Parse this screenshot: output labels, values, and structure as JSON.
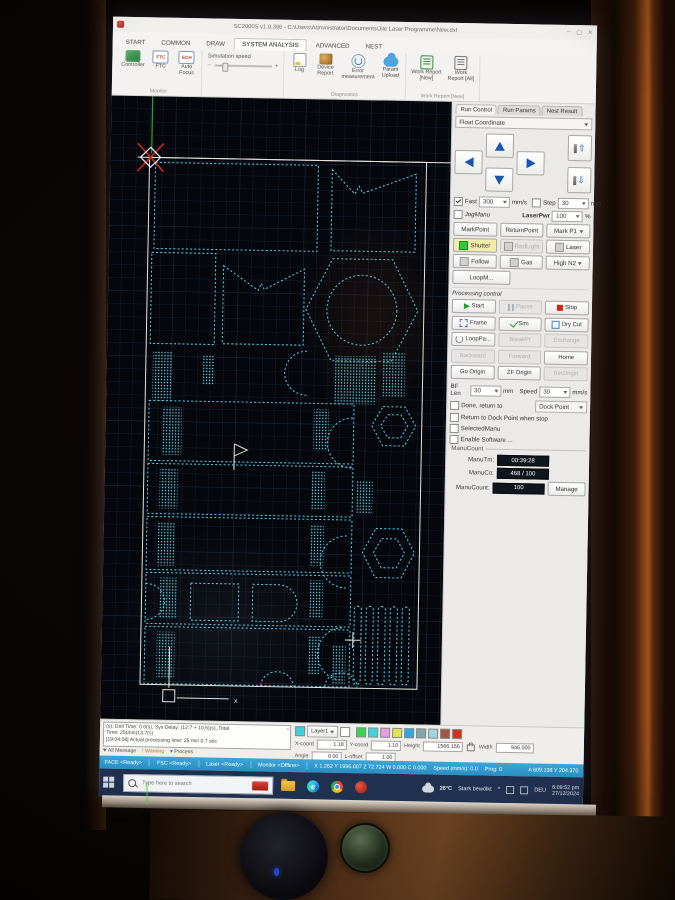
{
  "window": {
    "title": "SC2000S v1.0.396 - C:\\Users\\Administrator\\Documents\\Jile Laser Programme\\New.dxf",
    "min": "–",
    "max": "▢",
    "close": "✕"
  },
  "ribbon": {
    "tabs": [
      {
        "label": "START"
      },
      {
        "label": "COMMON"
      },
      {
        "label": "DRAW"
      },
      {
        "label": "SYSTEM ANALYSIS"
      },
      {
        "label": "ADVANCED"
      },
      {
        "label": "NEST"
      }
    ],
    "monitor_group": {
      "label": "Monitor",
      "controller": "Controller",
      "ftc": "FTC",
      "ftc_icon": "FTC",
      "auto_focus": "Auto\nFocus",
      "auto_focus_icon": "ECH"
    },
    "simulation": {
      "label": "Simulation speed",
      "minus": "–",
      "plus": "+"
    },
    "diagnostics": {
      "label": "Diagnostics",
      "log": "Log",
      "device_report": "Device\nReport",
      "error_measure": "Error\nmeasurement",
      "param_upload": "Param\nUpload"
    },
    "work_report": {
      "label": "Work Report [New]",
      "new": "Work Report\n[New]",
      "all": "Work\nReport [All]"
    }
  },
  "panel": {
    "tabs": [
      "Run Control",
      "Run Params",
      "Nest Result"
    ],
    "coord_mode": "Float Coordinate",
    "jog": {
      "fast_label": "Fast",
      "fast_value": "300",
      "fast_unit": "mm/s",
      "step_label": "Step",
      "step_value": "30",
      "step_unit": "mm",
      "jogmanu": "JogManu",
      "laserpwr_label": "LaserPwr",
      "laserpwr_value": "100",
      "laserpwr_unit": "%",
      "z_up": "⇧",
      "z_down": "⇩"
    },
    "quick": {
      "markpoint": "MarkPoint",
      "returnpoint": "ReturnPoint",
      "markp1": "Mark P1",
      "shutter": "Shutter",
      "redlight": "RedLight",
      "laser": "Laser",
      "follow": "Follow",
      "gas": "Gas",
      "highn2": "High N2",
      "loopm": "LoopM..."
    },
    "processing": {
      "label": "Processing control",
      "buttons": [
        {
          "label": "Start",
          "icon": "play",
          "disabled": false
        },
        {
          "label": "Pause",
          "icon": "pause",
          "disabled": true
        },
        {
          "label": "Stop",
          "icon": "stop",
          "disabled": false
        },
        {
          "label": "Frame",
          "icon": "frame",
          "disabled": false
        },
        {
          "label": "Sim",
          "icon": "check",
          "disabled": false
        },
        {
          "label": "Dry Cut",
          "icon": "dry",
          "disabled": false
        },
        {
          "label": "LoopPa...",
          "icon": "loop",
          "disabled": false
        },
        {
          "label": "BreakPt",
          "icon": "none",
          "disabled": true
        },
        {
          "label": "Exchange",
          "icon": "none",
          "disabled": true
        },
        {
          "label": "Backward",
          "icon": "none",
          "disabled": true
        },
        {
          "label": "Forward",
          "icon": "none",
          "disabled": true
        },
        {
          "label": "Home",
          "icon": "none",
          "disabled": false
        },
        {
          "label": "Go Origin",
          "icon": "none",
          "disabled": false
        },
        {
          "label": "ZF Origin",
          "icon": "none",
          "disabled": false
        },
        {
          "label": "RetOrigin",
          "icon": "none",
          "disabled": true
        }
      ]
    },
    "bf": {
      "len_label": "BF Len",
      "len_value": "30",
      "len_unit": "mm",
      "speed_label": "Speed",
      "speed_value": "30",
      "speed_unit": "mm/s"
    },
    "options": {
      "done_return": "Done, return to",
      "dock_point": "Dock Point",
      "return_dock": "Return to Dock Point when stop",
      "selected_manu": "SelectedManu",
      "enable_software": "Enable Software ..."
    },
    "manucount": {
      "group_label": "ManuCount",
      "time_label": "ManuTm:",
      "time_value": "00:39:28",
      "count_label": "ManuCo:",
      "count_value": "468 / 100",
      "total_label": "ManuCount:",
      "total_value": "100",
      "manage": "Manage"
    }
  },
  "log": {
    "lines": [
      "(s), Drill Time: 0.0(s), Sys Delay: (12.7 + 10.6)(s),  Total",
      "Time: 25(min)13.7(s)",
      "[19:04:08] Actual processing time: 25 min 0.7 sec"
    ],
    "filters": [
      "All Message",
      "Warning",
      "Process"
    ],
    "scroll_glyph": "˄"
  },
  "layers": {
    "current": "Layer1",
    "current_color": "#3ecfe0",
    "swatches": [
      "#35d455",
      "#3ed4e0",
      "#e59ddc",
      "#e3e34e",
      "#2fa8e0",
      "#7fa8a8",
      "#a5d4de",
      "#a05545",
      "#d32f20"
    ]
  },
  "coords_panel": {
    "xcoord_label": "X-coord",
    "xcoord_value": "1.18",
    "ycoord_label": "Y-coord",
    "ycoord_value": "1.10",
    "height_label": "Height",
    "height_value": "1566.156",
    "width_label": "Width",
    "width_value": "946.000",
    "angle_label": "Angle",
    "angle_value": "0.00",
    "loffset_label": "L-offset",
    "loffset_value": "1.00"
  },
  "statusbar": {
    "items": [
      "FACE <Ready>",
      "FSC <Ready>",
      "Laser <Ready>",
      "Monitor <Offline>"
    ],
    "coords": "X 1.262  Y 1996.007  Z 72.724  W 0.000  C 0.000",
    "speed": "Speed (mm/s):  0.0",
    "prog": "Prog: 0",
    "right": "A 609.138  Y 204.370"
  },
  "taskbar": {
    "search_placeholder": "Type here to search",
    "edge_letter": "e",
    "weather_temp": "26°C",
    "weather_text": "Stark bewölkt",
    "caret": "^",
    "lang": "DEU",
    "time": "6:09:52 pm",
    "date": "27/12/2024"
  },
  "canvas": {
    "axis_label": "x",
    "shapes": [
      {
        "t": "line",
        "x1": 27,
        "y1": 61,
        "x2": 340,
        "y2": 61,
        "cls": "white"
      },
      {
        "t": "rect",
        "x": 39,
        "y": 61,
        "w": 277,
        "h": 527,
        "cls": "frame"
      },
      {
        "t": "line",
        "x1": 41,
        "y1": 0,
        "x2": 41,
        "y2": 57,
        "cls": "green"
      },
      {
        "t": "path",
        "d": "M27,47 L53,75 M53,47 L27,75",
        "cls": "red"
      },
      {
        "t": "path",
        "d": "M40,51 L50,61 L40,71 L30,61 Z",
        "cls": "wmark"
      },
      {
        "t": "rect",
        "x": 45,
        "y": 66,
        "w": 163,
        "h": 86,
        "cls": "dash"
      },
      {
        "t": "path",
        "d": "M222,70 L245,94 L249,86 L253,93 L306,73 L306,151 L222,151 Z",
        "cls": "dash"
      },
      {
        "t": "rect",
        "x": 43,
        "y": 156,
        "w": 64,
        "h": 91,
        "cls": "dash"
      },
      {
        "t": "path",
        "d": "M115,168 L150,192 L153,185 L156,191 L196,170 L196,246 L115,246 Z",
        "cls": "dash"
      },
      {
        "t": "path",
        "d": "M224,159 L284,159 L310,210 L284,261 L224,261 L198,210 Z",
        "cls": "dash"
      },
      {
        "t": "circle",
        "cx": 254,
        "cy": 210,
        "r": 35,
        "cls": "dash"
      },
      {
        "t": "hatch",
        "x": 46,
        "y": 254,
        "w": 20,
        "h": 50
      },
      {
        "t": "hatch",
        "x": 96,
        "y": 258,
        "w": 12,
        "h": 30
      },
      {
        "t": "path",
        "d": "M200,252 a20,20 0 0 0 0,44",
        "cls": "dash"
      },
      {
        "t": "hatch",
        "x": 228,
        "y": 256,
        "w": 42,
        "h": 48
      },
      {
        "t": "hatch",
        "x": 276,
        "y": 252,
        "w": 22,
        "h": 44
      },
      {
        "t": "rect",
        "x": 43,
        "y": 304,
        "w": 205,
        "h": 60,
        "cls": "dash"
      },
      {
        "t": "rect",
        "x": 43,
        "y": 367,
        "w": 205,
        "h": 50,
        "cls": "dash"
      },
      {
        "t": "rect",
        "x": 43,
        "y": 420,
        "w": 205,
        "h": 53,
        "cls": "dash"
      },
      {
        "t": "rect",
        "x": 43,
        "y": 476,
        "w": 205,
        "h": 51,
        "cls": "dash"
      },
      {
        "t": "rect",
        "x": 43,
        "y": 530,
        "w": 205,
        "h": 57,
        "cls": "dash"
      },
      {
        "t": "hatch",
        "x": 56,
        "y": 310,
        "w": 20,
        "h": 48
      },
      {
        "t": "hatch",
        "x": 55,
        "y": 372,
        "w": 18,
        "h": 40
      },
      {
        "t": "hatch",
        "x": 54,
        "y": 425,
        "w": 18,
        "h": 44
      },
      {
        "t": "hatch",
        "x": 57,
        "y": 481,
        "w": 18,
        "h": 41
      },
      {
        "t": "hatch",
        "x": 55,
        "y": 535,
        "w": 18,
        "h": 46
      },
      {
        "t": "hatch",
        "x": 208,
        "y": 310,
        "w": 15,
        "h": 40
      },
      {
        "t": "hatch",
        "x": 206,
        "y": 372,
        "w": 14,
        "h": 38
      },
      {
        "t": "hatch",
        "x": 206,
        "y": 426,
        "w": 14,
        "h": 40
      },
      {
        "t": "hatch",
        "x": 207,
        "y": 481,
        "w": 13,
        "h": 38
      },
      {
        "t": "hatch",
        "x": 206,
        "y": 536,
        "w": 13,
        "h": 40
      },
      {
        "t": "rect",
        "x": 88,
        "y": 486,
        "w": 48,
        "h": 37,
        "cls": "dash"
      },
      {
        "t": "path",
        "d": "M150,486 h26 a18.5,18.5 0 0 1 0,37 h-26 Z",
        "cls": "dash"
      },
      {
        "t": "path",
        "d": "M43,487 a19,18 0 0 1 0,36",
        "cls": "dash"
      },
      {
        "t": "path",
        "d": "M160,587 a16,14 0 0 1 32,0",
        "cls": "dash"
      },
      {
        "t": "path",
        "d": "M224,587 a16,14 0 0 1 32,0",
        "cls": "dash"
      },
      {
        "t": "path",
        "d": "M247,318 a25,25 0 0 0 0,50",
        "cls": "dash"
      },
      {
        "t": "path",
        "d": "M243,436 a26,26 0 0 0 0,52",
        "cls": "dash"
      },
      {
        "t": "path",
        "d": "M277,306 L299,306 L310,325 L299,345 L277,345 L266,325 Z",
        "cls": "dash"
      },
      {
        "t": "path",
        "d": "M282,314 L295,314 L302,325 L295,337 L282,337 L275,325 Z",
        "cls": "dash"
      },
      {
        "t": "path",
        "d": "M272,428 L298,428 L311,452 L298,477 L272,477 L259,452 Z",
        "cls": "dash"
      },
      {
        "t": "path",
        "d": "M278,438 L293,438 L301,452 L293,467 L278,467 L270,452 Z",
        "cls": "dash"
      },
      {
        "t": "hatch",
        "x": 252,
        "y": 380,
        "w": 16,
        "h": 34
      },
      {
        "t": "rect",
        "x": 252,
        "y": 506,
        "w": 7,
        "h": 78,
        "rx": 3,
        "cls": "dash"
      },
      {
        "t": "rect",
        "x": 264,
        "y": 506,
        "w": 7,
        "h": 78,
        "rx": 3,
        "cls": "dash"
      },
      {
        "t": "rect",
        "x": 276,
        "y": 506,
        "w": 7,
        "h": 78,
        "rx": 3,
        "cls": "dash"
      },
      {
        "t": "rect",
        "x": 288,
        "y": 506,
        "w": 7,
        "h": 78,
        "rx": 3,
        "cls": "dash"
      },
      {
        "t": "rect",
        "x": 300,
        "y": 506,
        "w": 7,
        "h": 78,
        "rx": 3,
        "cls": "dash"
      },
      {
        "t": "path",
        "d": "M240,528 a24,26 0 0 0 0,52",
        "cls": "dash"
      },
      {
        "t": "hatch",
        "x": 230,
        "y": 546,
        "w": 14,
        "h": 38
      },
      {
        "t": "path",
        "d": "M129,346 v26 M129,346 l13,6 l-13,6",
        "cls": "white"
      },
      {
        "t": "path",
        "d": "M243,540 h16 M251,532 v16",
        "cls": "white"
      },
      {
        "t": "rect",
        "x": 62,
        "y": 593,
        "w": 12,
        "h": 12,
        "cls": "white"
      },
      {
        "t": "path",
        "d": "M68,591 V550",
        "cls": "white"
      },
      {
        "t": "path",
        "d": "M76,601 H128",
        "cls": "white"
      },
      {
        "t": "text",
        "x": 133,
        "y": 605,
        "s": "x",
        "cls": "wtext"
      }
    ]
  }
}
